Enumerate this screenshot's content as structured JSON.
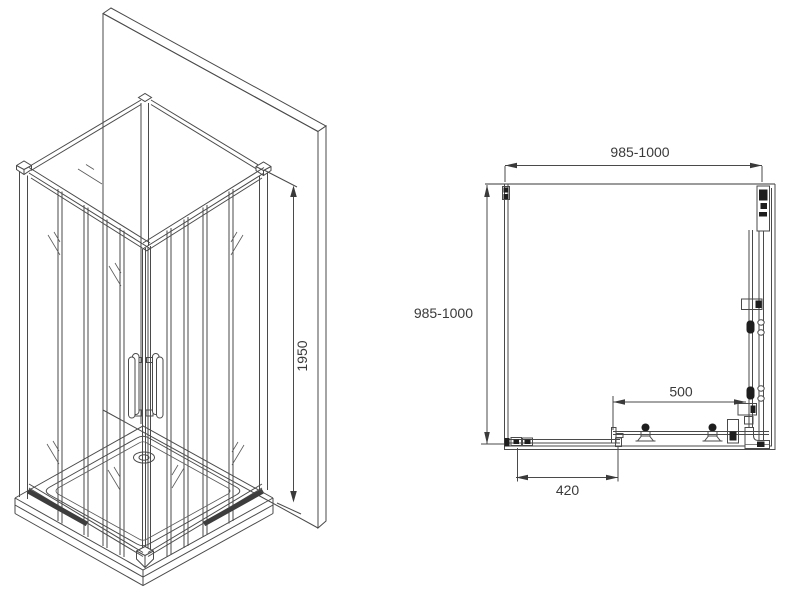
{
  "diagram": {
    "type": "technical-drawing",
    "subject": "corner shower enclosure with sliding doors",
    "iso_view": {
      "height_dim": "1950"
    },
    "plan_view": {
      "width_dim": "985-1000",
      "depth_dim": "985-1000",
      "right_panel_dim": "500",
      "door_panel_dim": "420"
    },
    "colors": {
      "line": "#4a4a4a",
      "hardware_dark": "#1e1e1e",
      "wall_gray": "#7a7a7a",
      "text": "#3a3a3a",
      "background": "#ffffff"
    }
  }
}
